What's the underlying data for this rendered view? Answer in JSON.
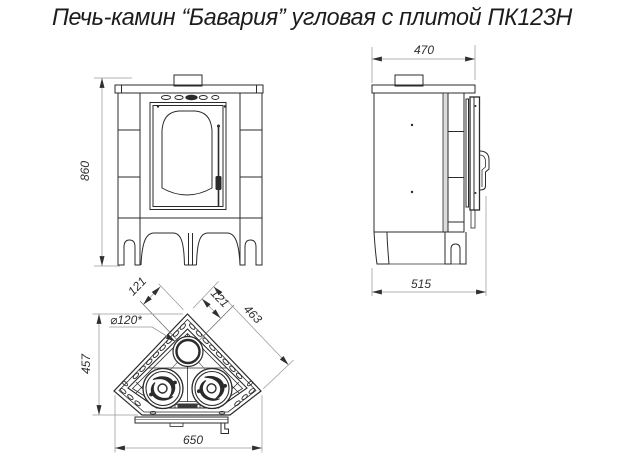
{
  "title": "Печь-камин “Бавария” угловая с плитой ПК123Н",
  "dims": {
    "front_height": "860",
    "side_top_width": "470",
    "side_depth": "515",
    "plan_width": "650",
    "plan_depth": "457",
    "plan_face_edge": "463",
    "flue_offset_left": "121",
    "flue_offset_right": "121",
    "flue_diameter": "⌀120*"
  },
  "colors": {
    "line": "#2b2b2b",
    "dim_line": "#9a9a9a",
    "dim_text": "#2f2f2f",
    "background": "#ffffff"
  }
}
